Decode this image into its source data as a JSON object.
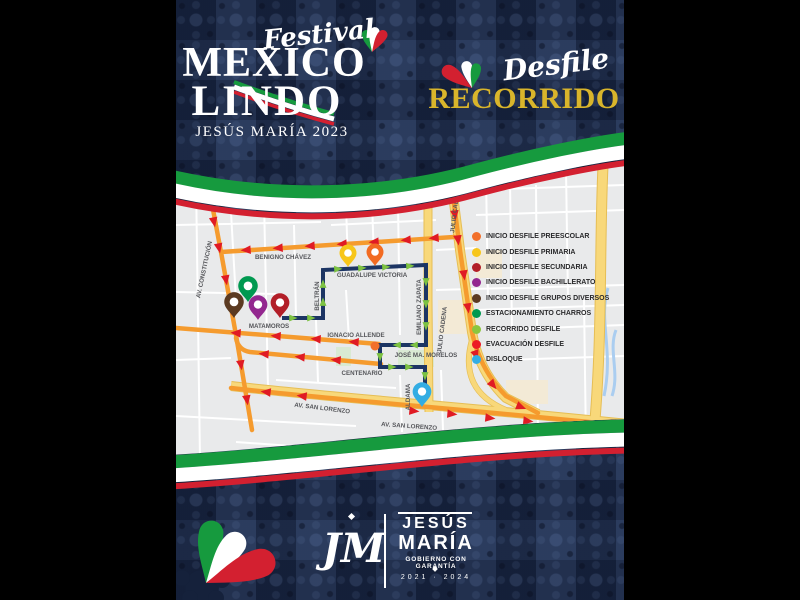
{
  "header": {
    "festival": "Festival",
    "title_line1": "MEXICO",
    "title_line2": "LINDO",
    "subtitle": "JESÚS MARÍA 2023",
    "desfile": "Desfile",
    "recorrido": "RECORRIDO"
  },
  "colors": {
    "poster_navy": "#1D2C4C",
    "gold": "#D9B52B",
    "ribbon_green": "#169A3E",
    "ribbon_white": "#FFFFFF",
    "ribbon_red": "#D32030",
    "map_bg": "#E9EAEB",
    "road_yellow": "#F8D87A",
    "road_yellow_border": "#E6BE55",
    "route_navy": "#1C3564",
    "route_green_arrow": "#7DC242",
    "evac_orange": "#F59B2E",
    "evac_red_arrow": "#E01B24"
  },
  "legend": {
    "items": [
      {
        "label": "INICIO DESFILE PREESCOLAR",
        "color": "#F2702B"
      },
      {
        "label": "INICIO DESFILE PRIMARIA",
        "color": "#F7C61A"
      },
      {
        "label": "INICIO DESFILE SECUNDARIA",
        "color": "#B21E28"
      },
      {
        "label": "INICIO DESFILE BACHILLERATO",
        "color": "#93278F"
      },
      {
        "label": "INICIO DESFILE GRUPOS DIVERSOS",
        "color": "#5B3A21"
      },
      {
        "label": "ESTACIONAMIENTO CHARROS",
        "color": "#009950"
      },
      {
        "label": "RECORRIDO DESFILE",
        "color": "#8CC63E"
      },
      {
        "label": "EVACUACIÓN DESFILE",
        "color": "#EC1B24"
      },
      {
        "label": "DISLOQUE",
        "color": "#33ADE3"
      }
    ]
  },
  "map": {
    "labels": {
      "benigno": "BENIGNO CHÁVEZ",
      "guadalupe": "GUADALUPE VICTORIA",
      "beltran": "BELTRÁN",
      "constitucion": "AV. CONSTITUCIÓN",
      "matamoros": "MATAMOROS",
      "allende": "IGNACIO ALLENDE",
      "centenario": "CENTENARIO",
      "zapata": "EMILIANO ZAPATA",
      "julio": "JULIO CADENA",
      "morelos": "JOSÉ MA. MORELOS",
      "aldama": "ALDAMA",
      "san_lorenzo": "AV. SAN LORENZO"
    },
    "pins": [
      {
        "name": "inicio-primaria",
        "color": "#F7C61A"
      },
      {
        "name": "inicio-preescolar",
        "color": "#F26B22"
      },
      {
        "name": "estacionamiento-charros",
        "color": "#009950"
      },
      {
        "name": "grupos-diversos",
        "color": "#5B3A21"
      },
      {
        "name": "bachillerato",
        "color": "#93278F"
      },
      {
        "name": "secundaria",
        "color": "#B21E28"
      },
      {
        "name": "disloque",
        "color": "#33ADE3"
      }
    ]
  },
  "footer": {
    "monogram": "JM",
    "name_line1": "JESÚS",
    "name_line2": "MARÍA",
    "tagline": "GOBIERNO CON GARANTÍA",
    "years": "2021 · 2024"
  }
}
